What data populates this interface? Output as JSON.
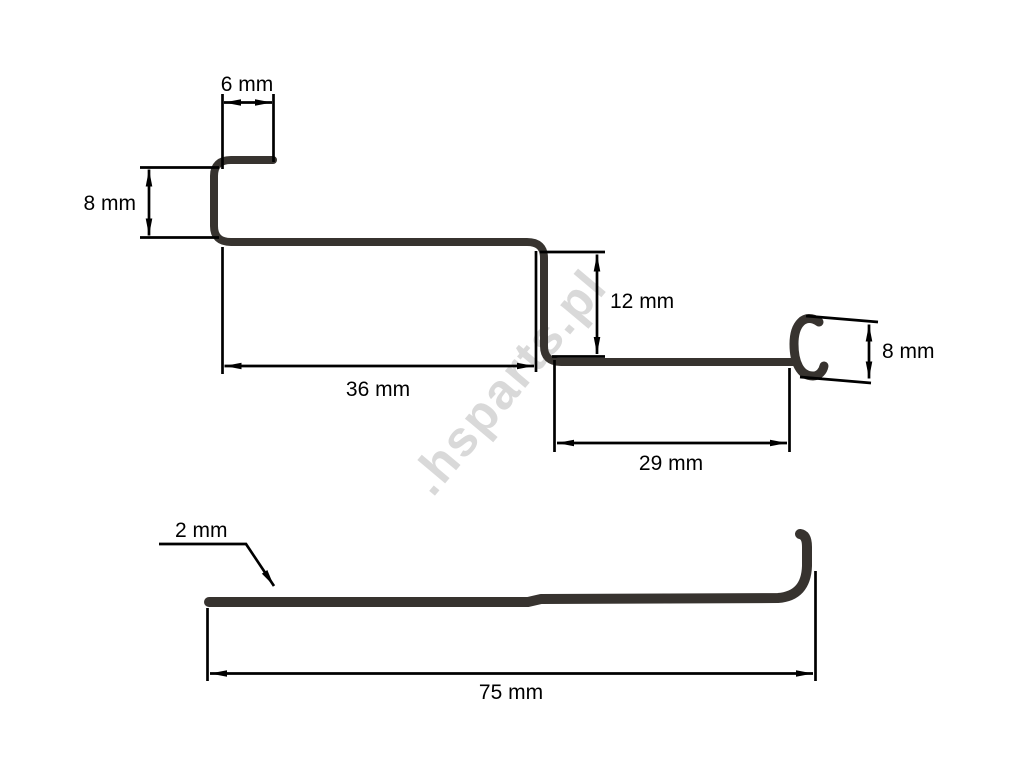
{
  "watermark": {
    "text": ".hsparts.pl",
    "color": "#d9d9d9"
  },
  "colors": {
    "wire": "#37332f",
    "lines": "#000000",
    "background": "#ffffff"
  },
  "top_view": {
    "dims": {
      "top_hook_width": {
        "label": "6 mm",
        "value": 6,
        "unit": "mm"
      },
      "left_step_height": {
        "label": "8 mm",
        "value": 8,
        "unit": "mm"
      },
      "upper_span": {
        "label": "36 mm",
        "value": 36,
        "unit": "mm"
      },
      "center_drop": {
        "label": "12 mm",
        "value": 12,
        "unit": "mm"
      },
      "lower_span": {
        "label": "29 mm",
        "value": 29,
        "unit": "mm"
      },
      "end_loop_height": {
        "label": "8 mm",
        "value": 8,
        "unit": "mm"
      }
    }
  },
  "bottom_view": {
    "dims": {
      "wire_diameter": {
        "label": "2 mm",
        "value": 2,
        "unit": "mm"
      },
      "overall_length": {
        "label": "75 mm",
        "value": 75,
        "unit": "mm"
      }
    }
  }
}
